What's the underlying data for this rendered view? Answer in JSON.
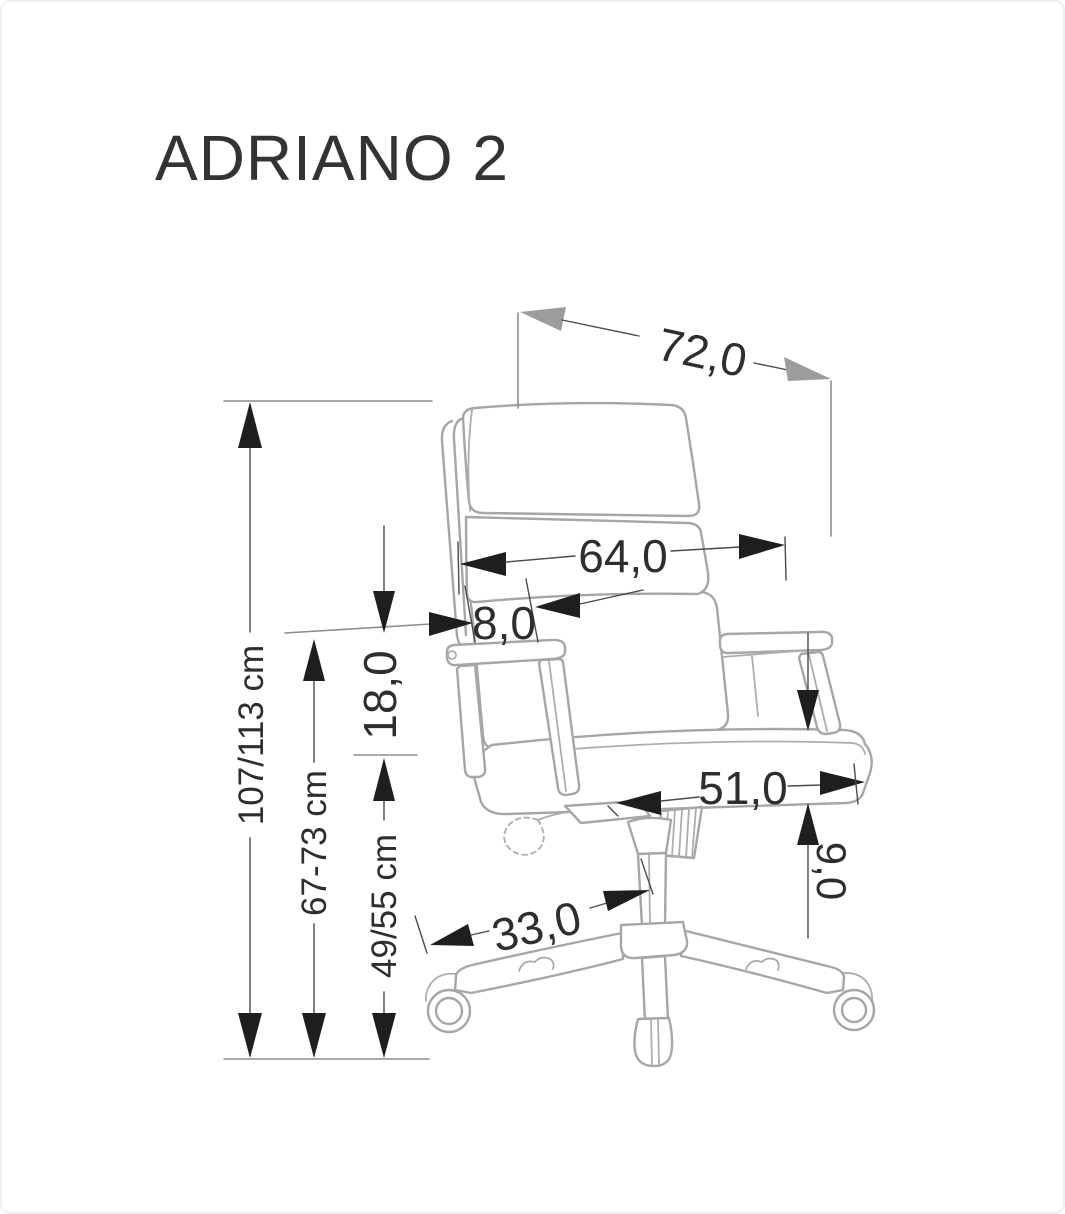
{
  "title": "ADRIANO 2",
  "diagram": {
    "kind": "furniture-dimension-drawing",
    "subject": "office swivel chair, side view",
    "units": "cm"
  },
  "dimensions": {
    "overall_depth": {
      "label": "72,0",
      "description": "overall depth (top diagonal)"
    },
    "backrest_width": {
      "label": "64,0",
      "description": "backrest width"
    },
    "backrest_thickness": {
      "label": "8,0",
      "description": "backrest cushion thickness"
    },
    "seat_to_armrest": {
      "label": "18,0",
      "description": "seat to armrest height"
    },
    "overall_height": {
      "label": "107/113 cm",
      "description": "overall height range"
    },
    "floor_to_armrest": {
      "label": "67-73 cm",
      "description": "floor to armrest height range"
    },
    "seat_height": {
      "label": "49/55 cm",
      "description": "floor to seat height range"
    },
    "seat_depth": {
      "label": "51,0",
      "description": "seat depth"
    },
    "seat_thickness": {
      "label": "9,0",
      "description": "seat cushion thickness"
    },
    "base_leg_length": {
      "label": "33,0",
      "description": "base leg length"
    }
  },
  "colors": {
    "background": "#ffffff",
    "chair_line": "#a6a6a6",
    "dimension_line": "#4b4b4b",
    "arrow_black": "#1e1e1e",
    "arrow_gray": "#9c9c9c",
    "text": "#2e2e2e"
  }
}
